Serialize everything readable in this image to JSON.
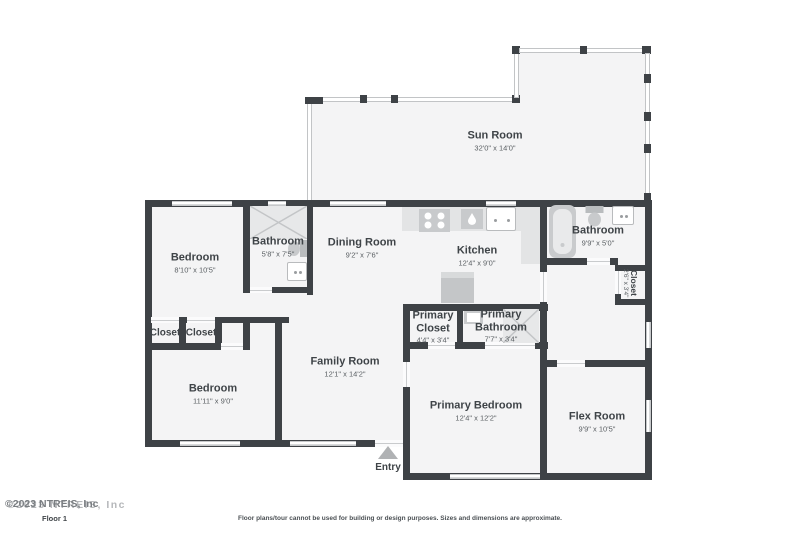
{
  "rooms": [
    {
      "name": "Sun Room",
      "dims": "32'0\" x 14'0\""
    },
    {
      "name": "Bedroom",
      "dims": "8'10\" x 10'5\""
    },
    {
      "name": "Bathroom",
      "dims": "5'8\" x 7'5\""
    },
    {
      "name": "Dining Room",
      "dims": "9'2\" x 7'6\""
    },
    {
      "name": "Kitchen",
      "dims": "12'4\" x 9'0\""
    },
    {
      "name": "Bathroom",
      "dims": "9'9\" x 5'0\""
    },
    {
      "name": "Closet",
      "dims": "2'6\" x 3'4\""
    },
    {
      "name": "Closet"
    },
    {
      "name": "Closet"
    },
    {
      "name": "Bedroom",
      "dims": "11'11\" x 9'0\""
    },
    {
      "name": "Family Room",
      "dims": "12'1\" x 14'2\""
    },
    {
      "name": "Primary Closet",
      "dims": "4'4\" x 3'4\""
    },
    {
      "name": "Primary Bathroom",
      "dims": "7'7\" x 3'4\""
    },
    {
      "name": "Primary Bedroom",
      "dims": "12'4\" x 12'2\""
    },
    {
      "name": "Flex Room",
      "dims": "9'9\" x 10'5\""
    }
  ],
  "entry": {
    "label": "Entry"
  },
  "floor_label": "Floor 1",
  "watermark": {
    "text": "©2023 NTREIS, Inc"
  },
  "disclaimer": "Floor plans/tour cannot be used for building or design purposes. Sizes and dimensions are approximate.",
  "colors": {
    "wall": "#3e4246",
    "room_fill": "#f4f4f5",
    "fixture": "#c8cacc",
    "text": "#3f4448"
  }
}
